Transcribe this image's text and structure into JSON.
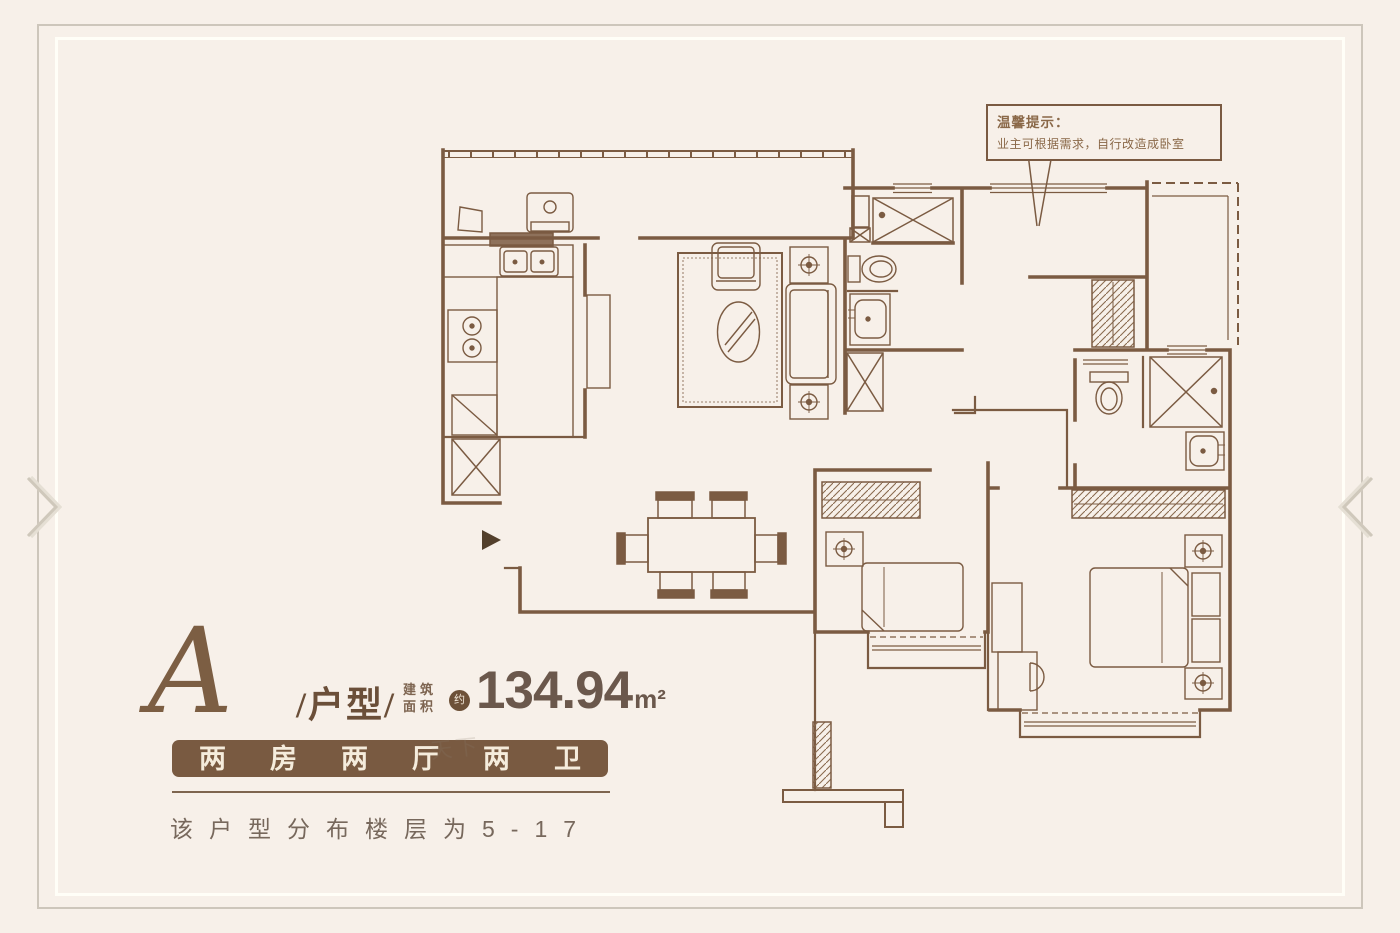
{
  "colors": {
    "background": "#f7f0e9",
    "plan_line": "#7b5b42",
    "banner_background": "#795a41",
    "banner_text": "#f5ecdc",
    "title_text": "#6b4f39",
    "area_text": "#6b584c",
    "frame_outer": "#cdc6bb",
    "frame_inner": "#fffef7",
    "arrow": "#d6cfc3"
  },
  "carousel": {
    "prev_icon": "chevron-right-icon",
    "next_icon": "chevron-left-icon"
  },
  "callout": {
    "title": "温馨提示：",
    "body": "业主可根据需求，自行改造成卧室"
  },
  "unit": {
    "type_letter": "A",
    "type_label": "/户型/",
    "area_label_line1": "建筑",
    "area_label_line2": "面积",
    "area_approx": "约",
    "area_value": "134.94",
    "area_unit": "m²",
    "layout_banner": "两房两厅两卫",
    "floors_note": "该户型分布楼层为5-17"
  },
  "watermark": "天下"
}
